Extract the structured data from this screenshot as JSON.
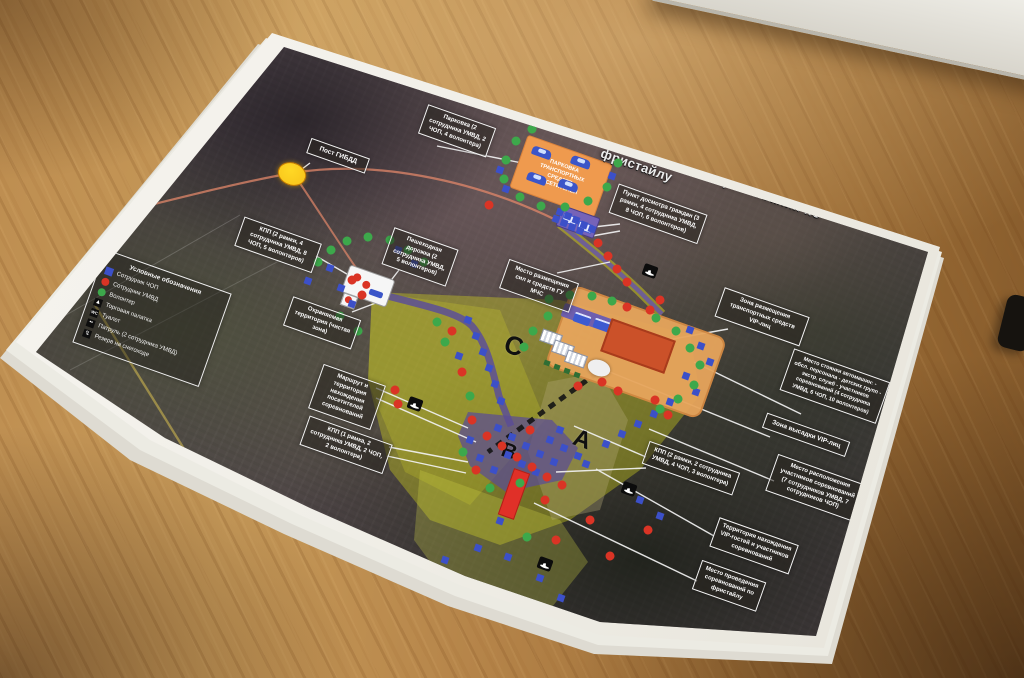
{
  "scene": {
    "colors": {
      "paper": "#f4f2ec",
      "marker_blue": "#3c50c8",
      "marker_red": "#da3425",
      "marker_green": "#3da84b",
      "zone_yellow": "#d6d61e",
      "path_purple": "#5c4f96",
      "parking_orange": "#ef9a4e",
      "stands_red": "#cb5129",
      "road_orange": "#e2876a",
      "gibdd_yellow": "#f7c21a"
    }
  },
  "map": {
    "title": "СХЕМА",
    "subtitle": "зонирования территории проведения соревнований по фристайлу",
    "feature_labels": {
      "visitor_parking": "ПАРКОВКА ТРАНСПОРТНЫХ СРЕДСТВ ПОСЕТИТЕЛЕЙ"
    },
    "legend": {
      "title": "Условные обозначения",
      "items": [
        {
          "marker": "blue-square",
          "label": "Сотрудник ЧОП"
        },
        {
          "marker": "red-circle",
          "label": "Сотрудник УМВД"
        },
        {
          "marker": "green-circle",
          "label": "Волонтер"
        },
        {
          "marker": "tent-icon",
          "label": "Торговая палатка"
        },
        {
          "marker": "toilet-icon",
          "label": "Туалет"
        },
        {
          "marker": "patrol-icon",
          "label": "Патруль (2 сотрудника УМВД)"
        },
        {
          "marker": "snowmobile-icon",
          "label": "Резерв на снегоходе"
        }
      ]
    },
    "zone_letters": [
      {
        "id": "zone-c",
        "text": "С",
        "x": 514,
        "y": 346,
        "size": 26
      },
      {
        "id": "zone-a",
        "text": "А",
        "x": 582,
        "y": 440,
        "size": 24
      },
      {
        "id": "zone-b",
        "text": "В",
        "x": 509,
        "y": 452,
        "size": 21
      }
    ],
    "callouts": [
      {
        "id": "gibdd",
        "text": "Пост ГИБДД",
        "x": 338,
        "y": 156,
        "w": 52,
        "fs": 6.5
      },
      {
        "id": "parking",
        "text": "Парковка (2 сотрудника УМВД, 2 ЧОП, 4 волонтера)",
        "x": 457,
        "y": 131,
        "w": 62,
        "fs": 6
      },
      {
        "id": "dosmotr",
        "text": "Пункт досмотра граждан (3 рамки, 4 сотрудника УМВД, 8 ЧОП, 6 волонтеров)",
        "x": 658,
        "y": 214,
        "w": 84,
        "fs": 6
      },
      {
        "id": "kpp-west",
        "text": "КПП (2 рамки, 4 сотрудника УМВД, 8 ЧОП, 5 волонтеров)",
        "x": 278,
        "y": 245,
        "w": 72,
        "fs": 6
      },
      {
        "id": "footpath",
        "text": "Пешеходная дорожка (2 сотрудника УМВД, 5 волонтеров)",
        "x": 420,
        "y": 257,
        "w": 58,
        "fs": 6
      },
      {
        "id": "secured",
        "text": "Охраняемая территория (чистая зона)",
        "x": 322,
        "y": 323,
        "w": 62,
        "fs": 6
      },
      {
        "id": "route",
        "text": "Маршрут и территория нахождения посетителей соревнований",
        "x": 347,
        "y": 397,
        "w": 56,
        "fs": 6
      },
      {
        "id": "kpp-south",
        "text": "КПП (1 рамка, 2 сотрудника УМВД, 2 ЧОП, 2 волонтера)",
        "x": 346,
        "y": 445,
        "w": 78,
        "fs": 6
      },
      {
        "id": "mchs",
        "text": "Место размещения сил и средств ГУ МЧС",
        "x": 539,
        "y": 286,
        "w": 64,
        "fs": 6
      },
      {
        "id": "vip-transport",
        "text": "Зона размещения транспортных средств VIP-лиц",
        "x": 762,
        "y": 317,
        "w": 80,
        "fs": 6
      },
      {
        "id": "car-park",
        "text": "Место стоянки автомашин: - обсл. персонала - детских групп - экстр. служб - участников соревнований (4 сотрудника УМВД, 6 ЧОП, 10 волонтеров)",
        "x": 835,
        "y": 386,
        "w": 92,
        "fs": 5.5
      },
      {
        "id": "vip-dropoff",
        "text": "Зона высадки VIP-лиц",
        "x": 806,
        "y": 435,
        "w": 78,
        "fs": 6.5
      },
      {
        "id": "kpp-east",
        "text": "КПП (2 рамки, 2 сотрудника УМВД, 4 ЧОП, 3 волонтера)",
        "x": 691,
        "y": 468,
        "w": 86,
        "fs": 6
      },
      {
        "id": "participants",
        "text": "Место расположения участников соревнований (7 сотрудников УМВД, 7 сотрудников ЧОП)",
        "x": 816,
        "y": 488,
        "w": 84,
        "fs": 6
      },
      {
        "id": "vip-guests",
        "text": "Территория нахождения VIP-гостей и участников соревнований",
        "x": 754,
        "y": 546,
        "w": 74,
        "fs": 6
      },
      {
        "id": "venue",
        "text": "Место проведения соревнований по фристайлу",
        "x": 729,
        "y": 586,
        "w": 58,
        "fs": 6
      }
    ],
    "leader_lines": [
      [
        310,
        163,
        298,
        172
      ],
      [
        437,
        146,
        522,
        163
      ],
      [
        620,
        224,
        585,
        228
      ],
      [
        620,
        231,
        592,
        236
      ],
      [
        316,
        256,
        352,
        277
      ],
      [
        399,
        270,
        382,
        292
      ],
      [
        352,
        312,
        381,
        301
      ],
      [
        376,
        388,
        468,
        428
      ],
      [
        376,
        398,
        476,
        442
      ],
      [
        389,
        447,
        468,
        462
      ],
      [
        387,
        456,
        466,
        473
      ],
      [
        557,
        273,
        610,
        262
      ],
      [
        728,
        329,
        662,
        341
      ],
      [
        801,
        414,
        694,
        362
      ],
      [
        770,
        437,
        605,
        370
      ],
      [
        646,
        457,
        574,
        426
      ],
      [
        646,
        468,
        556,
        472
      ],
      [
        774,
        481,
        649,
        429
      ],
      [
        714,
        536,
        596,
        469
      ],
      [
        697,
        581,
        534,
        503
      ]
    ],
    "markers": {
      "blue_squares": [
        [
          560,
          212
        ],
        [
          568,
          216
        ],
        [
          576,
          220
        ],
        [
          584,
          225
        ],
        [
          592,
          229
        ],
        [
          564,
          223
        ],
        [
          572,
          227
        ],
        [
          580,
          231
        ],
        [
          556,
          219
        ],
        [
          500,
          170
        ],
        [
          506,
          189
        ],
        [
          612,
          176
        ],
        [
          330,
          268
        ],
        [
          341,
          288
        ],
        [
          352,
          304
        ],
        [
          398,
          250
        ],
        [
          414,
          264
        ],
        [
          308,
          281
        ],
        [
          468,
          320
        ],
        [
          476,
          336
        ],
        [
          483,
          352
        ],
        [
          489,
          368
        ],
        [
          495,
          384
        ],
        [
          501,
          401
        ],
        [
          459,
          356
        ],
        [
          498,
          428
        ],
        [
          512,
          437
        ],
        [
          526,
          446
        ],
        [
          540,
          454
        ],
        [
          554,
          462
        ],
        [
          508,
          455
        ],
        [
          522,
          464
        ],
        [
          536,
          472
        ],
        [
          494,
          470
        ],
        [
          480,
          458
        ],
        [
          470,
          440
        ],
        [
          550,
          440
        ],
        [
          564,
          448
        ],
        [
          578,
          456
        ],
        [
          560,
          430
        ],
        [
          586,
          464
        ],
        [
          690,
          330
        ],
        [
          701,
          346
        ],
        [
          710,
          362
        ],
        [
          686,
          376
        ],
        [
          696,
          392
        ],
        [
          670,
          402
        ],
        [
          654,
          414
        ],
        [
          638,
          424
        ],
        [
          622,
          434
        ],
        [
          606,
          444
        ],
        [
          500,
          521
        ],
        [
          478,
          548
        ],
        [
          508,
          557
        ],
        [
          540,
          578
        ],
        [
          561,
          598
        ],
        [
          515,
          598
        ],
        [
          468,
          581
        ],
        [
          445,
          560
        ],
        [
          640,
          500
        ],
        [
          660,
          516
        ]
      ],
      "red_circles": [
        [
          598,
          243
        ],
        [
          608,
          256
        ],
        [
          617,
          269
        ],
        [
          627,
          282
        ],
        [
          489,
          205
        ],
        [
          615,
          131
        ],
        [
          352,
          280
        ],
        [
          362,
          295
        ],
        [
          627,
          307
        ],
        [
          650,
          310
        ],
        [
          602,
          382
        ],
        [
          618,
          391
        ],
        [
          578,
          386
        ],
        [
          660,
          300
        ],
        [
          487,
          436
        ],
        [
          502,
          446
        ],
        [
          517,
          457
        ],
        [
          532,
          467
        ],
        [
          476,
          470
        ],
        [
          547,
          477
        ],
        [
          562,
          485
        ],
        [
          472,
          420
        ],
        [
          530,
          430
        ],
        [
          395,
          390
        ],
        [
          398,
          404
        ],
        [
          452,
          331
        ],
        [
          462,
          372
        ],
        [
          428,
          588
        ],
        [
          556,
          540
        ],
        [
          610,
          556
        ],
        [
          590,
          520
        ],
        [
          545,
          500
        ],
        [
          448,
          602
        ],
        [
          655,
          400
        ],
        [
          668,
          415
        ],
        [
          648,
          530
        ]
      ],
      "green_circles": [
        [
          506,
          160
        ],
        [
          516,
          141
        ],
        [
          532,
          129
        ],
        [
          553,
          121
        ],
        [
          576,
          119
        ],
        [
          597,
          128
        ],
        [
          611,
          144
        ],
        [
          618,
          163
        ],
        [
          607,
          187
        ],
        [
          588,
          201
        ],
        [
          565,
          207
        ],
        [
          541,
          206
        ],
        [
          520,
          197
        ],
        [
          504,
          179
        ],
        [
          318,
          262
        ],
        [
          331,
          250
        ],
        [
          347,
          241
        ],
        [
          368,
          237
        ],
        [
          390,
          240
        ],
        [
          408,
          250
        ],
        [
          424,
          262
        ],
        [
          340,
          316
        ],
        [
          358,
          331
        ],
        [
          549,
          299
        ],
        [
          570,
          295
        ],
        [
          592,
          296
        ],
        [
          612,
          301
        ],
        [
          548,
          316
        ],
        [
          533,
          331
        ],
        [
          524,
          347
        ],
        [
          656,
          318
        ],
        [
          676,
          331
        ],
        [
          690,
          348
        ],
        [
          700,
          365
        ],
        [
          694,
          385
        ],
        [
          678,
          399
        ],
        [
          660,
          409
        ],
        [
          445,
          342
        ],
        [
          470,
          396
        ],
        [
          437,
          322
        ],
        [
          463,
          452
        ],
        [
          490,
          488
        ],
        [
          520,
          483
        ],
        [
          527,
          537
        ]
      ],
      "black_icons": [
        [
          650,
          271
        ],
        [
          415,
          404
        ],
        [
          629,
          489
        ],
        [
          545,
          564
        ]
      ]
    }
  }
}
